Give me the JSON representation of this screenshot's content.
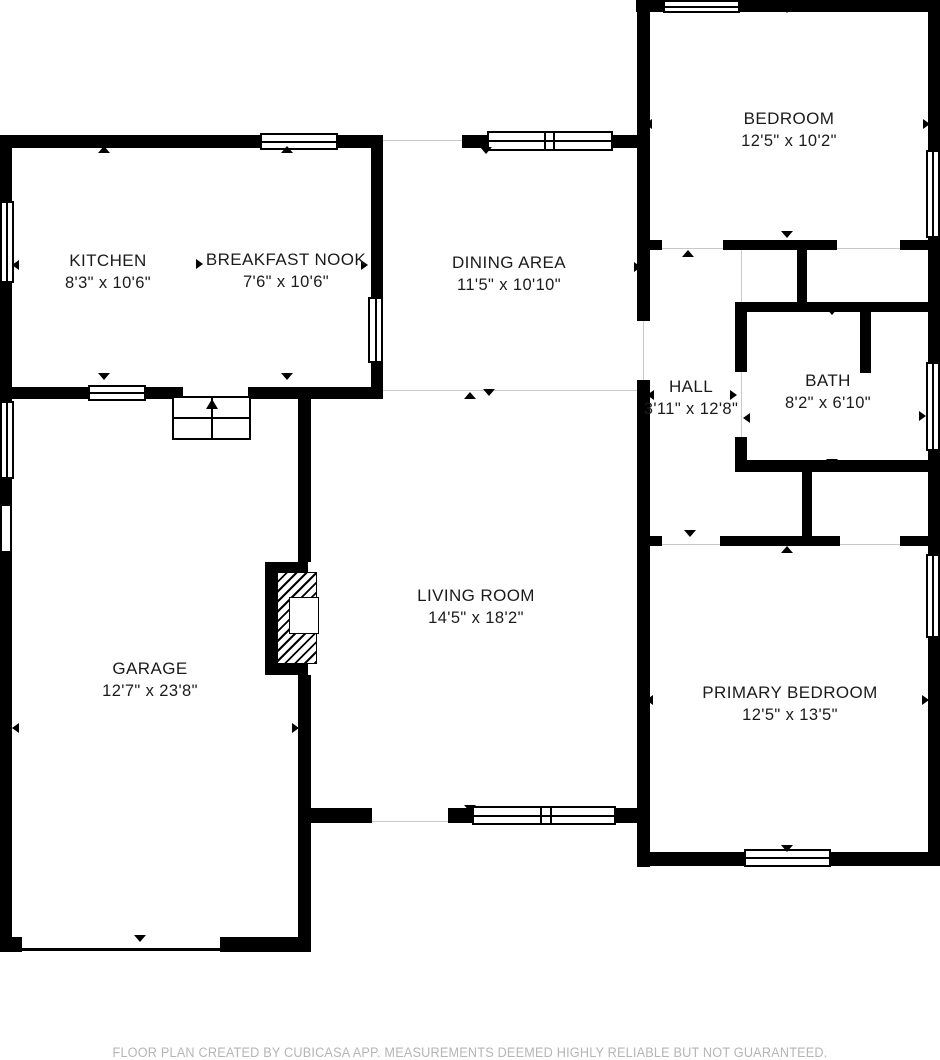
{
  "rooms": {
    "kitchen": {
      "name": "KITCHEN",
      "dims": "8'3\" x 10'6\""
    },
    "breakfast_nook": {
      "name": "BREAKFAST NOOK",
      "dims": "7'6\" x 10'6\""
    },
    "dining_area": {
      "name": "DINING AREA",
      "dims": "11'5\" x 10'10\""
    },
    "bedroom": {
      "name": "BEDROOM",
      "dims": "12'5\" x 10'2\""
    },
    "hall": {
      "name": "HALL",
      "dims": "3'11\" x 12'8\""
    },
    "bath": {
      "name": "BATH",
      "dims": "8'2\" x 6'10\""
    },
    "living_room": {
      "name": "LIVING ROOM",
      "dims": "14'5\" x 18'2\""
    },
    "garage": {
      "name": "GARAGE",
      "dims": "12'7\" x 23'8\""
    },
    "primary_bedroom": {
      "name": "PRIMARY BEDROOM",
      "dims": "12'5\" x 13'5\""
    }
  },
  "footer": {
    "disclaimer": "FLOOR PLAN CREATED BY CUBICASA APP. MEASUREMENTS DEEMED HIGHLY RELIABLE BUT NOT GUARANTEED."
  },
  "colors": {
    "wall": "#000000",
    "room_text": "#1b1b1b",
    "footer_text": "#b5b5b5",
    "opening_line": "#c9c9c9",
    "background": "#ffffff"
  }
}
